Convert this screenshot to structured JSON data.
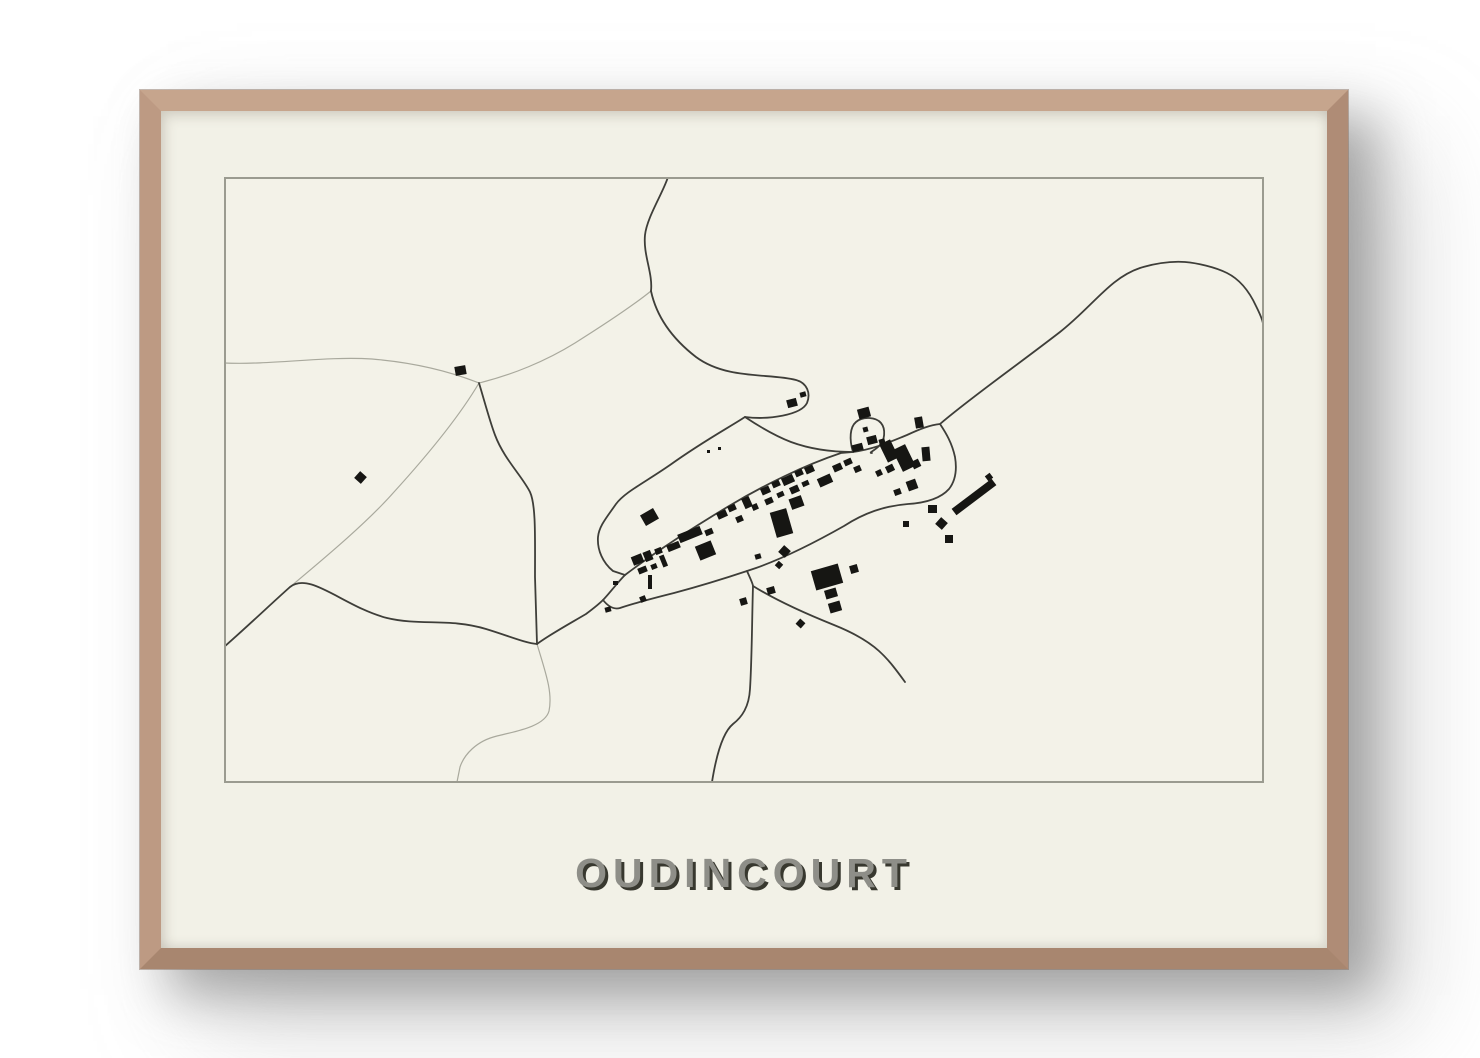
{
  "poster": {
    "title": "OUDINCOURT"
  },
  "colors": {
    "page_bg": "#ffffff",
    "frame_wood": "#b7947d",
    "mat": "#f2f1e7",
    "map_bg": "#f3f2e8",
    "map_border": "#9b9b90",
    "road_dark": "#3e3e39",
    "road_light": "#a9a99d",
    "building": "#161613",
    "title_fill": "#8e8e88",
    "title_shadow": "#38382f"
  },
  "map": {
    "viewbox": "0 0 1040 606",
    "border_rect": {
      "x": 1,
      "y": 1,
      "w": 1038,
      "h": 604,
      "stroke_width": 2
    },
    "road_dark_width": 1.8,
    "road_light_width": 1.2,
    "roads_dark": [
      "M444,0 C439,16 423,40 421,58 C419,78 429,96 427,114",
      "M427,114 C433,142 450,163 472,180 C503,203 546,196 572,203 C583,206 587,216 583,226 C577,238 545,243 521,240",
      "M521,240 C504,251 478,265 446,288 C420,306 401,315 392,327 C383,340 375,349 374,360 C373,373 379,386 389,394 L401,398",
      "M521,240 C533,248 549,258 567,265 C586,272 606,275 629,275",
      "M401,398 C430,376 470,350 505,329 C540,308 581,288 617,276 L629,275",
      "M629,275 C651,272 668,264 683,258 C696,252 706,248 716,247 C745,222 792,189 836,155 C869,129 886,101 916,91 C929,87 946,84 961,85 C973,86 991,90 1003,96 C1017,103 1026,116 1032,129 C1038,141 1040,147 1040,154",
      "M716,247 C722,256 728,266 731,280 C733,292 732,303 725,312 C716,322 700,326 684,327 C660,329 640,336 620,349 C590,366 560,381 532,391 L523,394 C505,400 480,408 450,416 C430,421 408,427 396,431 C389,433 383,428 379,423",
      "M523,394 C527,403 529,407 529,409 C528,440 528,480 526,512 C525,530 518,540 509,547 C498,556 492,580 488,605",
      "M529,409 C550,422 580,436 610,448 C630,456 645,465 655,474 C665,483 673,494 681,505",
      "M629,275 C625,262 626,250 632,245 C639,239 652,240 657,246 C662,252 661,264 655,269 C650,274 644,276 648,276",
      "M255,206 C261,226 266,245 271,258 C280,282 298,299 306,315 C312,328 311,360 311,400 L313,467",
      "M0,470 C25,448 48,426 66,410 C86,394 120,430 163,441 C196,449 226,441 262,452 C285,459 301,466 313,467",
      "M313,467 C325,458 345,447 362,437 C370,431 375,427 379,423 C385,417 393,406 401,398"
    ],
    "roads_light": [
      "M0,186 C50,188 100,179 148,182 C196,186 230,196 255,206",
      "M255,206 C288,198 322,184 351,166 C378,149 406,131 427,114",
      "M255,206 C235,240 200,282 170,315 C141,348 92,388 66,410",
      "M313,467 C321,494 329,515 325,534 C321,549 294,554 273,559 C252,564 240,578 236,590 L233,605"
    ],
    "buildings": [
      [
        231,
        189,
        11,
        9,
        -10
      ],
      [
        132,
        296,
        9,
        9,
        42
      ],
      [
        418,
        334,
        15,
        12,
        -30
      ],
      [
        389,
        404,
        5,
        4,
        0
      ],
      [
        381,
        430,
        6,
        5,
        -15
      ],
      [
        408,
        378,
        11,
        9,
        -22
      ],
      [
        420,
        374,
        8,
        10,
        -22
      ],
      [
        431,
        371,
        7,
        6,
        -22
      ],
      [
        414,
        390,
        9,
        6,
        -22
      ],
      [
        427,
        387,
        6,
        5,
        -22
      ],
      [
        437,
        378,
        5,
        12,
        -22
      ],
      [
        424,
        398,
        4,
        14,
        0
      ],
      [
        416,
        419,
        6,
        6,
        -22
      ],
      [
        443,
        366,
        13,
        7,
        -22
      ],
      [
        454,
        353,
        24,
        9,
        -22
      ],
      [
        473,
        366,
        17,
        15,
        -22
      ],
      [
        481,
        352,
        8,
        6,
        -22
      ],
      [
        493,
        334,
        10,
        7,
        -24
      ],
      [
        504,
        328,
        8,
        6,
        -24
      ],
      [
        512,
        339,
        7,
        6,
        -24
      ],
      [
        519,
        320,
        8,
        11,
        -24
      ],
      [
        528,
        327,
        6,
        6,
        -24
      ],
      [
        537,
        310,
        9,
        7,
        -24
      ],
      [
        548,
        304,
        8,
        6,
        -24
      ],
      [
        558,
        299,
        12,
        8,
        -24
      ],
      [
        571,
        293,
        8,
        6,
        -24
      ],
      [
        581,
        289,
        9,
        7,
        -24
      ],
      [
        541,
        321,
        8,
        6,
        -24
      ],
      [
        553,
        315,
        7,
        5,
        -24
      ],
      [
        566,
        309,
        9,
        7,
        -24
      ],
      [
        578,
        304,
        7,
        5,
        -24
      ],
      [
        549,
        333,
        17,
        26,
        -16
      ],
      [
        566,
        320,
        13,
        11,
        -20
      ],
      [
        594,
        299,
        14,
        9,
        -24
      ],
      [
        609,
        287,
        9,
        7,
        -24
      ],
      [
        620,
        282,
        8,
        6,
        -24
      ],
      [
        630,
        289,
        7,
        6,
        -24
      ],
      [
        563,
        222,
        10,
        8,
        -15
      ],
      [
        576,
        215,
        6,
        5,
        -15
      ],
      [
        634,
        231,
        12,
        10,
        -15
      ],
      [
        628,
        267,
        11,
        7,
        -15
      ],
      [
        643,
        259,
        10,
        8,
        -15
      ],
      [
        639,
        250,
        5,
        5,
        -15
      ],
      [
        655,
        262,
        6,
        5,
        -15
      ],
      [
        659,
        264,
        12,
        20,
        -26
      ],
      [
        673,
        269,
        14,
        24,
        -26
      ],
      [
        688,
        283,
        8,
        8,
        -26
      ],
      [
        662,
        288,
        8,
        7,
        -26
      ],
      [
        652,
        293,
        6,
        6,
        -26
      ],
      [
        691,
        240,
        8,
        11,
        -10
      ],
      [
        698,
        270,
        8,
        14,
        -5
      ],
      [
        683,
        303,
        10,
        10,
        -20
      ],
      [
        670,
        312,
        7,
        6,
        -20
      ],
      [
        704,
        328,
        9,
        8,
        0
      ],
      [
        713,
        342,
        9,
        9,
        42
      ],
      [
        721,
        358,
        8,
        8,
        0
      ],
      [
        725,
        316,
        50,
        8,
        -37
      ],
      [
        762,
        297,
        6,
        6,
        -37
      ],
      [
        589,
        390,
        28,
        20,
        -16
      ],
      [
        601,
        412,
        12,
        9,
        -16
      ],
      [
        626,
        388,
        8,
        8,
        -16
      ],
      [
        605,
        425,
        12,
        10,
        -16
      ],
      [
        543,
        410,
        8,
        7,
        -16
      ],
      [
        556,
        370,
        9,
        9,
        42
      ],
      [
        573,
        443,
        7,
        7,
        42
      ],
      [
        516,
        421,
        7,
        7,
        -16
      ],
      [
        531,
        377,
        6,
        5,
        -16
      ],
      [
        552,
        385,
        6,
        6,
        42
      ],
      [
        483,
        273,
        3,
        3,
        0
      ],
      [
        494,
        270,
        3,
        3,
        0
      ],
      [
        679,
        344,
        6,
        6,
        0
      ]
    ]
  }
}
